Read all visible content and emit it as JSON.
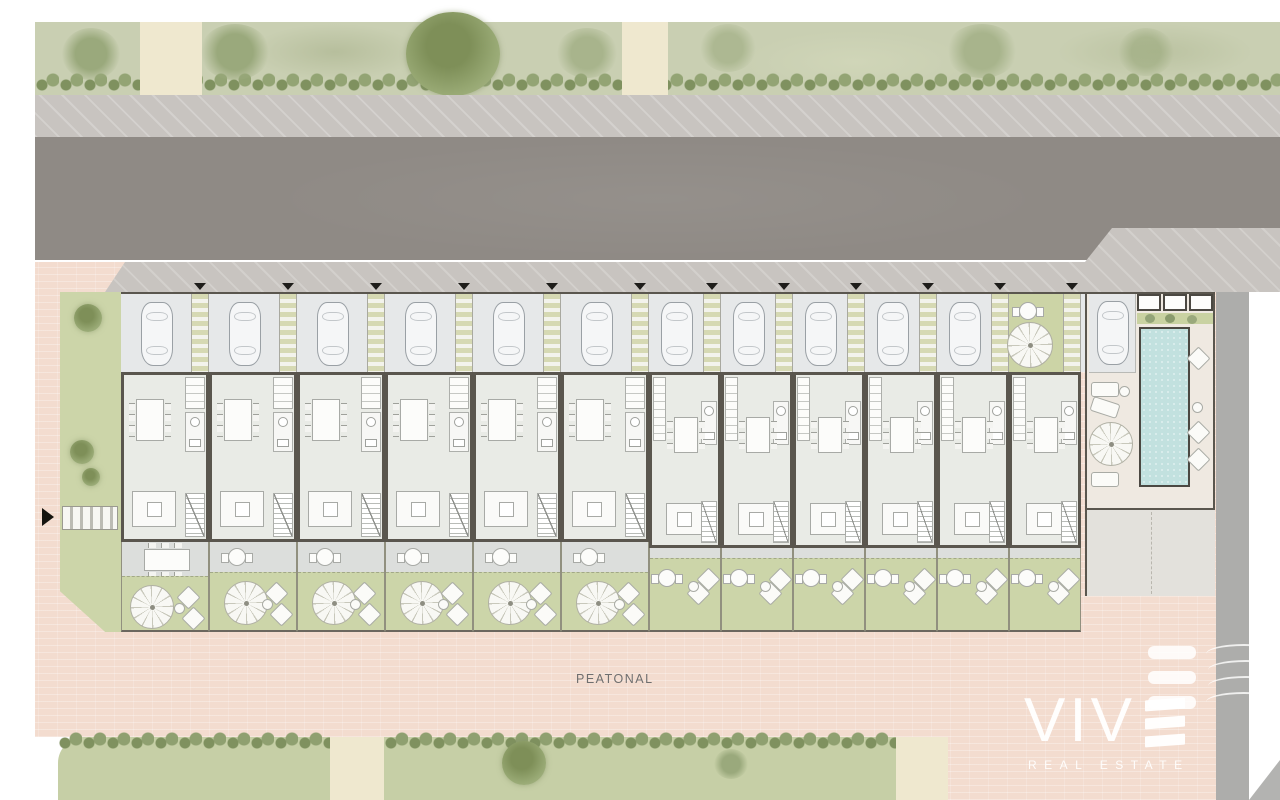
{
  "scene": {
    "type": "architectural-site-plan",
    "street_label": "PEATONAL",
    "description": "Top-view site plan of a row of townhouses with street, private parking, gardens, communal pool and pedestrian plaza"
  },
  "logo": {
    "brand_letters": "VIV",
    "brand_last_letter_bars": 3,
    "tagline": "REAL ESTATE"
  },
  "units": {
    "count": 12,
    "items": [
      {
        "id": 1,
        "type": "A",
        "parking": "car"
      },
      {
        "id": 2,
        "type": "A",
        "parking": "car"
      },
      {
        "id": 3,
        "type": "A",
        "parking": "car"
      },
      {
        "id": 4,
        "type": "A",
        "parking": "car"
      },
      {
        "id": 5,
        "type": "A",
        "parking": "car"
      },
      {
        "id": 6,
        "type": "A",
        "parking": "car"
      },
      {
        "id": 7,
        "type": "B",
        "parking": "car"
      },
      {
        "id": 8,
        "type": "B",
        "parking": "car"
      },
      {
        "id": 9,
        "type": "B",
        "parking": "car"
      },
      {
        "id": 10,
        "type": "B",
        "parking": "car"
      },
      {
        "id": 11,
        "type": "B",
        "parking": "car"
      },
      {
        "id": 12,
        "type": "B",
        "parking": "patio"
      }
    ]
  },
  "amenities": {
    "pool": true,
    "visitor_parking_cars": 1,
    "sun_loungers": 3,
    "benches": 3,
    "pedestrian_crossing": true,
    "entrance_arrow": true
  },
  "colors": {
    "grass": "#c9cfb2",
    "lawn": "#ccd5a9",
    "lawn2": "#c6cfa6",
    "path": "#efe8cf",
    "sidewalk": "#c8c4c0",
    "road": "#8f8a85",
    "pink": "#f3dccf",
    "lane": "#adadab",
    "parking": "#e6e8e9",
    "wall": "#5a564e",
    "floor": "#e9ebe6",
    "terrace": "#dcdedc",
    "deck": "#efe9e1",
    "pool": "#c2e1df"
  }
}
